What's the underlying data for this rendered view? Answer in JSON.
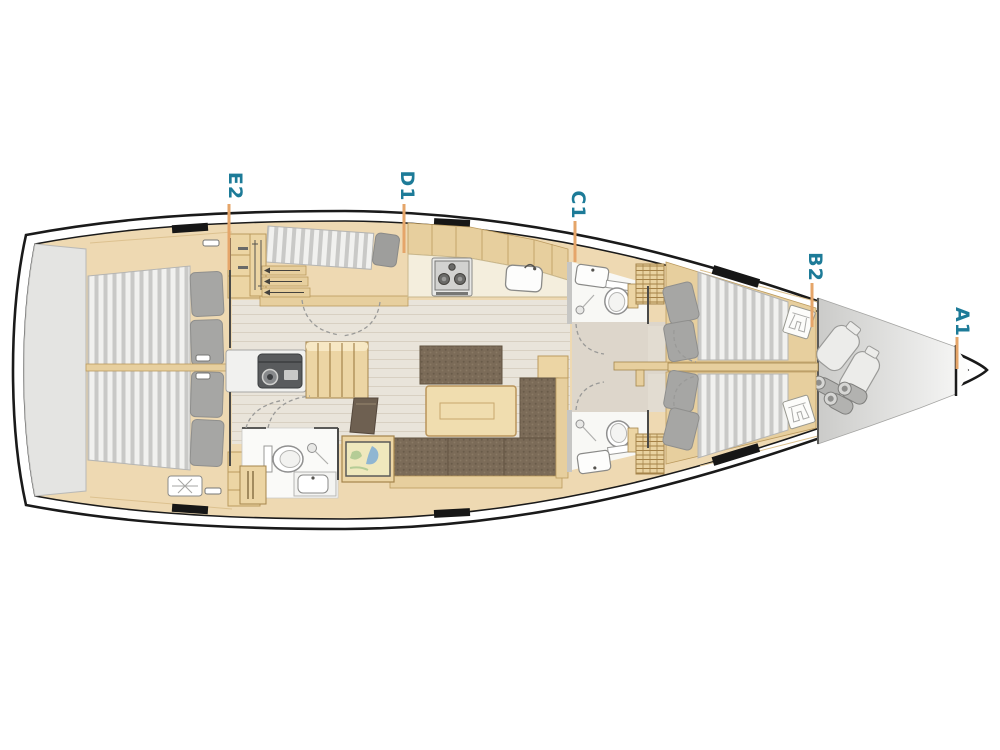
{
  "diagram": {
    "name": "sailing-yacht-deck-plan",
    "cabin_labels": [
      {
        "id": "E2",
        "text": "E2"
      },
      {
        "id": "D1",
        "text": "D1"
      },
      {
        "id": "C1",
        "text": "C1"
      },
      {
        "id": "B2",
        "text": "B2"
      },
      {
        "id": "A1",
        "text": "A1"
      }
    ],
    "colors": {
      "label_text": "#1d7b98",
      "leader_line": "#e5a569",
      "hull_outline": "#1a1a1a",
      "wood_light": "#eed9b2",
      "wood_mid": "#e7cf9e",
      "upholstery_brown": "#7b6b58",
      "mattress_stripe": "#c9c9c7",
      "platform_gray": "#e4e4e2"
    },
    "areas": [
      "swim-platform",
      "aft-cabin-port",
      "aft-cabin-starboard",
      "companionway",
      "engine-compartment",
      "galley",
      "saloon",
      "aft-head",
      "nav-station",
      "fore-head-port",
      "fore-head-starboard",
      "fore-cabin-port",
      "fore-cabin-starboard",
      "sail-locker",
      "bow-anchor-locker"
    ]
  }
}
